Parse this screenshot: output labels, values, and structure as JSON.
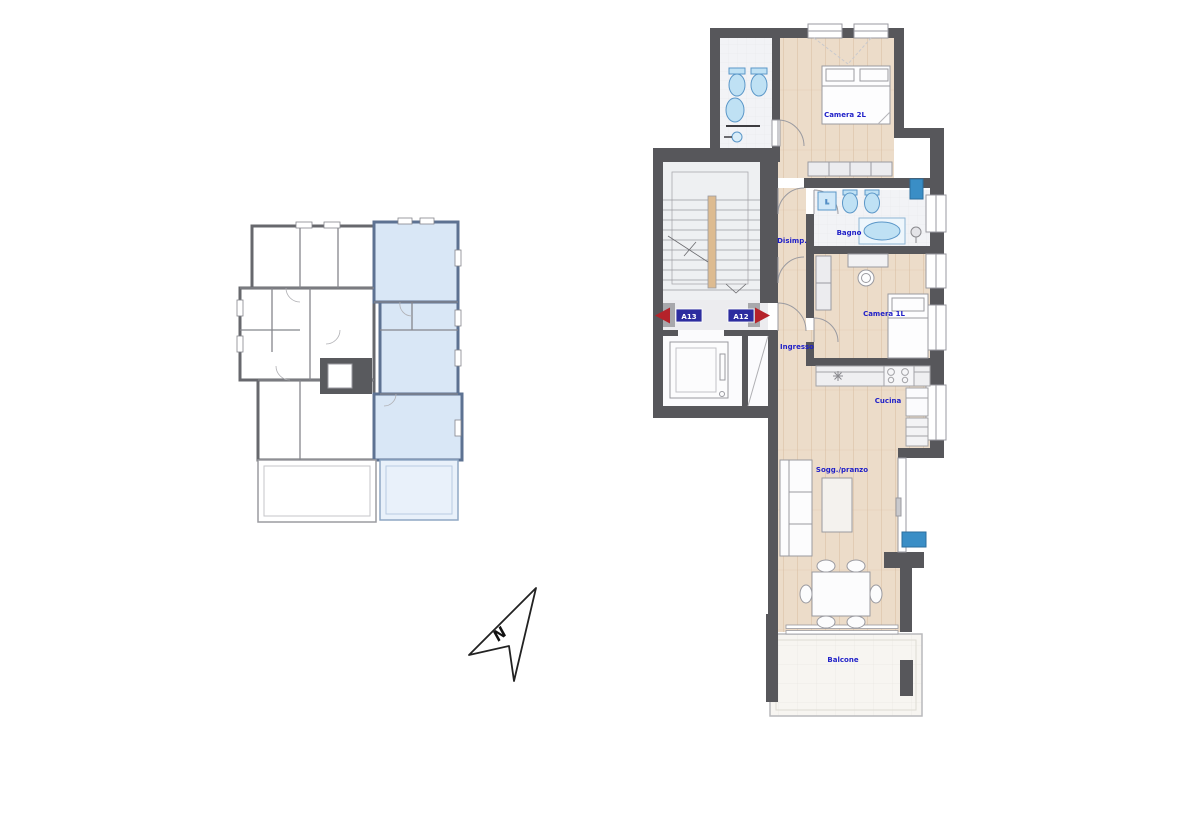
{
  "colors": {
    "wall": "#57575b",
    "wood_floor": "#ecdcc9",
    "bath_floor": "#f2f3f6",
    "stair_floor": "#eef0f2",
    "balcony_floor": "#f7f5f1",
    "fixture_fill": "#bfe1f4",
    "fixture_stroke": "#5b97c8",
    "label_blue": "#1f1fc8",
    "unit_tag_bg": "#2d2d9f",
    "entry_arrow_red": "#b5222a",
    "key_plan_highlight": "#d9e7f6",
    "key_plan_wall": "#67686d",
    "tech_blue": "#3a8ec6"
  },
  "north_arrow": {
    "label": "N"
  },
  "entry_tags": {
    "left": "A13",
    "right": "A12"
  },
  "rooms": {
    "camera_2l": "Camera 2L",
    "bagno": "Bagno",
    "disimpegno": "Disimp.",
    "camera_1l": "Camera 1L",
    "ingresso": "Ingresso",
    "cucina": "Cucina",
    "soggiorno_pranzo": "Sogg./pranzo",
    "balcone": "Balcone"
  },
  "appliances": {
    "washing_machine": "L"
  }
}
